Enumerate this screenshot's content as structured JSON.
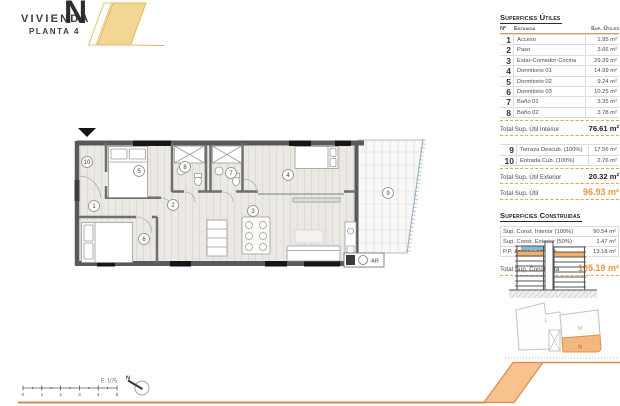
{
  "header": {
    "brand": "VIVIENDA",
    "unit_letter": "N",
    "floor": "PLANTA 4"
  },
  "surfaces_utiles": {
    "title": "Superficies Útiles",
    "columns": {
      "num": "Nº",
      "room": "Estancia",
      "sup": "Sup. Útiles"
    },
    "rows": [
      {
        "num": "1",
        "name": "Acceso",
        "value": "1.95 m²"
      },
      {
        "num": "2",
        "name": "Paso",
        "value": "3.66 m²"
      },
      {
        "num": "3",
        "name": "Estar-Comedor-Cocina",
        "value": "29.39 m²"
      },
      {
        "num": "4",
        "name": "Dormitorio 01",
        "value": "14.99 m²"
      },
      {
        "num": "5",
        "name": "Dormitorio 02",
        "value": "9.24 m²"
      },
      {
        "num": "6",
        "name": "Dormitorio 03",
        "value": "10.25 m²"
      },
      {
        "num": "7",
        "name": "Baño 01",
        "value": "3.35 m²"
      },
      {
        "num": "8",
        "name": "Baño 02",
        "value": "3.78 m²"
      }
    ],
    "total_interior": {
      "label": "Total Sup. Útil Interior",
      "value": "76.61 m²"
    },
    "exterior_rows": [
      {
        "num": "9",
        "name": "Terraza Descub. (100%)",
        "value": "17.56 m²"
      },
      {
        "num": "10",
        "name": "Entrada Cub. (100%)",
        "value": "2.76 m²"
      }
    ],
    "total_exterior": {
      "label": "Total Sup. Útil Exterior",
      "value": "20.32 m²"
    },
    "total": {
      "label": "Total Sup. Útil",
      "value": "96.93 m²"
    }
  },
  "surfaces_construidas": {
    "title": "Superficies Construidas",
    "rows": [
      {
        "name": "Sup. Const. Interior (100%)",
        "value": "90.54 m²"
      },
      {
        "name": "Sup. Const. Exterior (50%)",
        "value": "1.47 m²"
      },
      {
        "name": "P.P. Zonas Comunes",
        "value": "13.18 m²"
      }
    ],
    "total": {
      "label": "Total Sup. Construida",
      "value": "105.19 m²"
    }
  },
  "floor_plan": {
    "room_labels": {
      "r1": "1",
      "r2": "2",
      "r3": "3",
      "r4": "4",
      "r5": "5",
      "r6": "6",
      "r7": "7",
      "r8": "8",
      "r9": "9",
      "r10": "10"
    },
    "ar_label": "AR"
  },
  "site_plan": {
    "label_l": "L",
    "label_m": "M",
    "label_n": "N"
  },
  "scale_bar": {
    "label": "E: 1/75",
    "ticks": [
      "0",
      "1",
      "2",
      "3",
      "4",
      "5"
    ],
    "north_label": "N"
  },
  "colors": {
    "accent_orange": "#E8953F",
    "highlight_orange": "#F2AE6C",
    "gold": "#F3D694",
    "terrace_blue": "#85B8D8"
  }
}
